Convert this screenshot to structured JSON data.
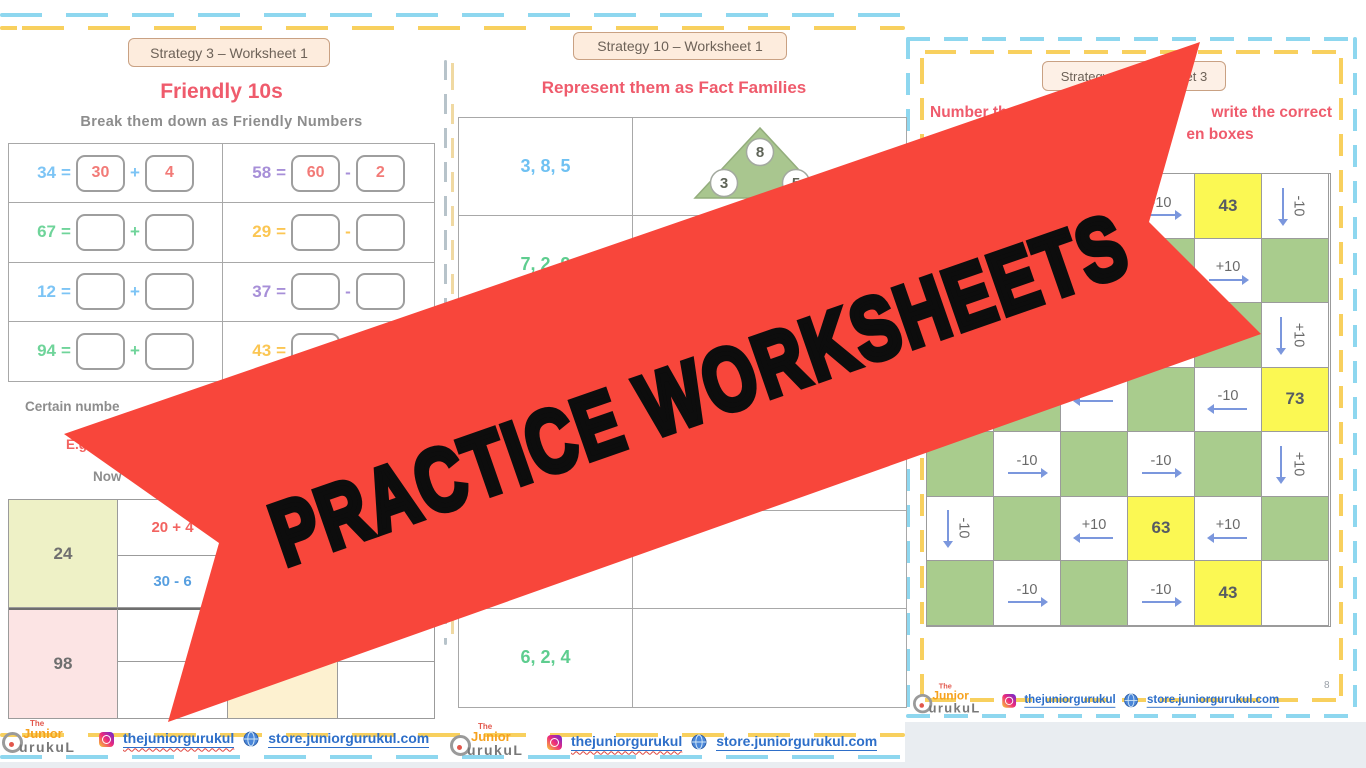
{
  "banner": {
    "text": "PRACTICE WORKSHEETS",
    "color": "#f8463b",
    "text_color": "#0d0d0d"
  },
  "footer": {
    "logo": {
      "the": "The",
      "junior": "Junior",
      "gurukul": "urukuL"
    },
    "instagram": "thejuniorgurukul",
    "store": "store.juniorgurukul.com"
  },
  "left": {
    "badge": "Strategy 3 – Worksheet 1",
    "title": "Friendly 10s",
    "subtitle": "Break them down as Friendly Numbers",
    "eq_sign": "=",
    "eq": [
      {
        "n": "34",
        "hex": "#7cc4f5",
        "b1": "30",
        "op": "+",
        "b2": "4"
      },
      {
        "n": "58",
        "hex": "#a78fd8",
        "b1": "60",
        "op": "-",
        "b2": "2"
      },
      {
        "n": "67",
        "hex": "#6fd49a",
        "b1": "",
        "op": "+",
        "b2": ""
      },
      {
        "n": "29",
        "hex": "#fbc653",
        "b1": "",
        "op": "-",
        "b2": ""
      },
      {
        "n": "12",
        "hex": "#7cc4f5",
        "b1": "",
        "op": "+",
        "b2": ""
      },
      {
        "n": "37",
        "hex": "#a78fd8",
        "b1": "",
        "op": "-",
        "b2": ""
      },
      {
        "n": "94",
        "hex": "#6fd49a",
        "b1": "",
        "op": "+",
        "b2": ""
      },
      {
        "n": "43",
        "hex": "#fbc653",
        "b1": "",
        "op": "-",
        "b2": ""
      }
    ],
    "certain_text": "Certain numbe",
    "eg_text": "E.g",
    "now_text": "Now",
    "table": {
      "r1_label": "24",
      "r1_cell1": "20 + 4",
      "r1_cell2": "30 - 6",
      "r2_label": "98"
    }
  },
  "middle": {
    "badge": "Strategy 10 – Worksheet 1",
    "title": "Represent them as Fact Families",
    "rows": [
      {
        "t": "3, 8, 5",
        "hex": "#6fc1f2"
      },
      {
        "t": "7, 2, 9",
        "hex": "#5ecd8f"
      },
      {
        "t": "6, 2, 4",
        "hex": "#5ecd8f"
      }
    ],
    "triangle": {
      "top": "8",
      "left": "3",
      "right": "5"
    }
  },
  "right": {
    "badge": "Strategy 2 – Worksheet 3",
    "heading_left": "Number th",
    "heading_right": "write the correct",
    "heading_line2": "en boxes",
    "page_number": "8",
    "grid": {
      "cells": [
        [
          {
            "c": "g"
          },
          {
            "c": "w"
          },
          {
            "c": "g"
          },
          {
            "c": "w",
            "t": "-10",
            "a": "r"
          },
          {
            "c": "y",
            "t": "43"
          },
          {
            "c": "w",
            "t": "-10",
            "a": "d"
          }
        ],
        [
          {
            "c": "w"
          },
          {
            "c": "g"
          },
          {
            "c": "w"
          },
          {
            "c": "g"
          },
          {
            "c": "w",
            "t": "+10",
            "a": "r"
          },
          {
            "c": "g"
          }
        ],
        [
          {
            "c": "g"
          },
          {
            "c": "w"
          },
          {
            "c": "g"
          },
          {
            "c": "w"
          },
          {
            "c": "g"
          },
          {
            "c": "w",
            "t": "+10",
            "a": "d"
          }
        ],
        [
          {
            "c": "w"
          },
          {
            "c": "g"
          },
          {
            "c": "w",
            "t": "",
            "a": "l"
          },
          {
            "c": "g"
          },
          {
            "c": "w",
            "t": "-10",
            "a": "l"
          },
          {
            "c": "y",
            "t": "73"
          }
        ],
        [
          {
            "c": "g"
          },
          {
            "c": "w",
            "t": "-10",
            "a": "r"
          },
          {
            "c": "g"
          },
          {
            "c": "w",
            "t": "-10",
            "a": "r"
          },
          {
            "c": "g"
          },
          {
            "c": "w",
            "t": "+10",
            "a": "d"
          }
        ],
        [
          {
            "c": "w",
            "t": "-10",
            "a": "d"
          },
          {
            "c": "g"
          },
          {
            "c": "w",
            "t": "+10",
            "a": "l"
          },
          {
            "c": "y",
            "t": "63"
          },
          {
            "c": "w",
            "t": "+10",
            "a": "l"
          },
          {
            "c": "g"
          }
        ],
        [
          {
            "c": "g"
          },
          {
            "c": "w",
            "t": "-10",
            "a": "r"
          },
          {
            "c": "g"
          },
          {
            "c": "w",
            "t": "-10",
            "a": "r"
          },
          {
            "c": "y",
            "t": "43"
          },
          {
            "c": "w"
          }
        ]
      ]
    }
  }
}
